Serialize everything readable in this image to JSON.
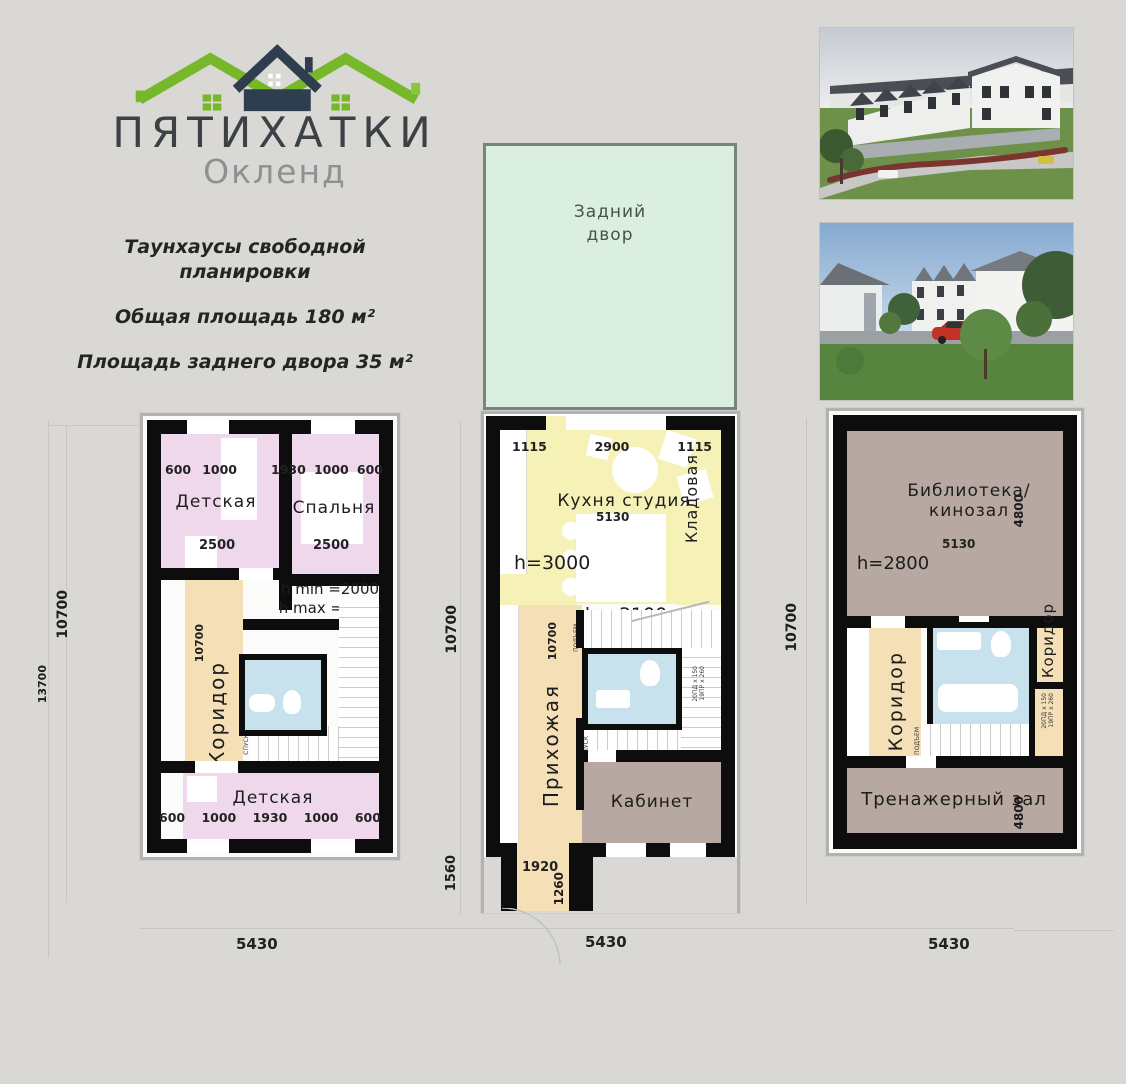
{
  "brand": {
    "title": "ПЯТИХАТКИ",
    "subtitle": "Окленд"
  },
  "summary": {
    "line1": "Таунхаусы свободной",
    "line2": "планировки",
    "area_total": "Общая площадь 180 м²",
    "area_yard": "Площадь заднего двора 35 м²"
  },
  "yard": {
    "line1": "Задний",
    "line2": "двор"
  },
  "plan1": {
    "dim_left_inner": "10700",
    "dim_left_outer": "13700",
    "dim_bottom": "5430",
    "top_left_room": {
      "name": "Детская",
      "dims_top": [
        "600",
        "1000"
      ],
      "dim_width": "2500"
    },
    "top_right_room": {
      "name": "Спальня",
      "dims_top": [
        "1930",
        "1000",
        "600"
      ],
      "dim_width": "2500"
    },
    "height_note1": "h min =2000",
    "height_note2": "h max =4910",
    "corridor": {
      "name": "Коридор",
      "dim": "10700"
    },
    "stair_down": "СПУСК",
    "bottom_room": {
      "name": "Детская",
      "dims_bottom": [
        "600",
        "1000",
        "1930",
        "1000",
        "600"
      ]
    }
  },
  "plan2": {
    "dim_left_main": "10700",
    "dim_left_porch": "1560",
    "dim_bottom": "5430",
    "dims_top": [
      "1115",
      "2900",
      "1115"
    ],
    "kitchen": {
      "name": "Кухня студия",
      "dim_width": "5130",
      "height_note": "h=3000"
    },
    "pantry": "Кладовая",
    "height_note_mid": "h =3100",
    "hall": {
      "name": "Прихожая",
      "dim": "10700"
    },
    "office": "Кабинет",
    "stair_up": "ПОДЪЕМ",
    "stair_down": "СПУСК",
    "stair_spec1": "20ПД x 150",
    "stair_spec2": "19ПР x 260",
    "porch": {
      "dim_width": "1920",
      "dim_depth": "1260"
    }
  },
  "plan3": {
    "dim_left": "10700",
    "dim_bottom": "5430",
    "library": {
      "name1": "Библиотека/",
      "name2": "кинозал",
      "dim_depth": "4800",
      "dim_width": "5130",
      "height_note": "h=2800"
    },
    "corridor_left": "Коридор",
    "corridor_right": "Коридор",
    "stair_up": "ПОДЪЕМ",
    "stair_spec1": "20ПД x 150",
    "stair_spec2": "19ПР x 260",
    "gym": {
      "name": "Тренажерный зал",
      "dim_depth": "4800"
    }
  },
  "palette": {
    "brand_green": "#76b82a",
    "brand_navy": "#2e3e4e",
    "room_pink": "#efd8ec",
    "room_tan": "#f4dfb6",
    "room_yellow": "#f6f1b6",
    "room_blue": "#c7e1ed",
    "room_brown": "#b7a8a1",
    "yard_green": "#daefe0",
    "wall_black": "#0d0d0d",
    "background": "#d9d8d5"
  }
}
